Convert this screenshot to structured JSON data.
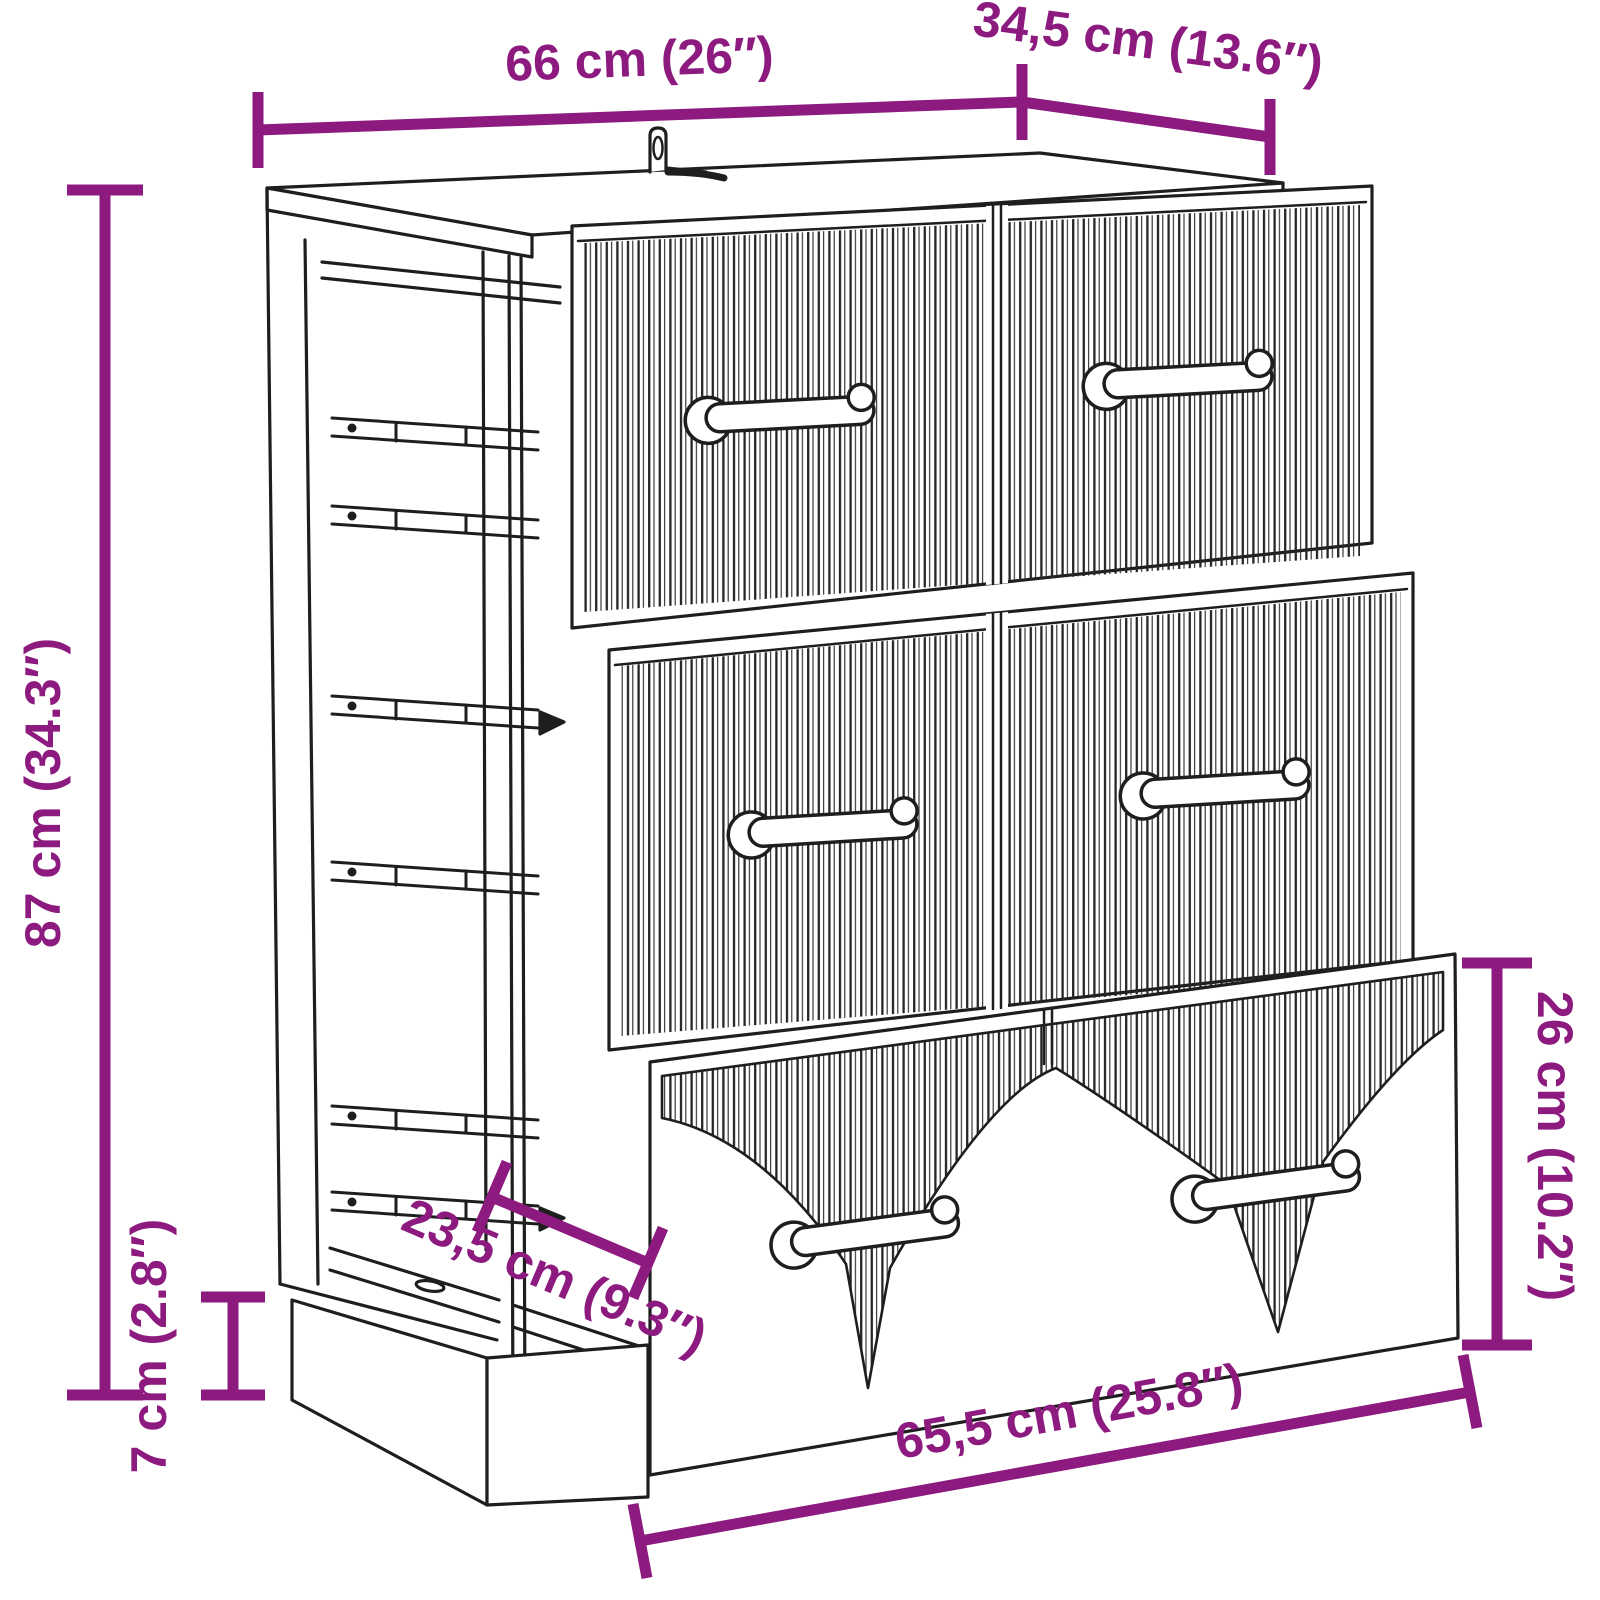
{
  "diagram": {
    "type": "product dimension drawing",
    "item": "sideboard with three fluted drawers, wall-mount bracket and plinth base",
    "background_color": "#FFFFFF",
    "dimension_color": "#8C1A7F",
    "line_art_color": "#1E1E1E"
  },
  "dimensions": {
    "top_width": {
      "label": "66 cm (26″)",
      "placement": "top"
    },
    "top_depth": {
      "label": "34,5 cm (13.6″)",
      "placement": "top-right"
    },
    "height": {
      "label": "87 cm (34.3″)",
      "placement": "left"
    },
    "plinth_height": {
      "label": "7 cm (2.8″)",
      "placement": "bottom-left"
    },
    "lower_depth": {
      "label": "23,5 cm (9.3″)",
      "placement": "center-left"
    },
    "drawer_height": {
      "label": "26 cm (10.2″)",
      "placement": "right"
    },
    "bottom_width": {
      "label": "65,5 cm (25.8″)",
      "placement": "bottom"
    }
  }
}
